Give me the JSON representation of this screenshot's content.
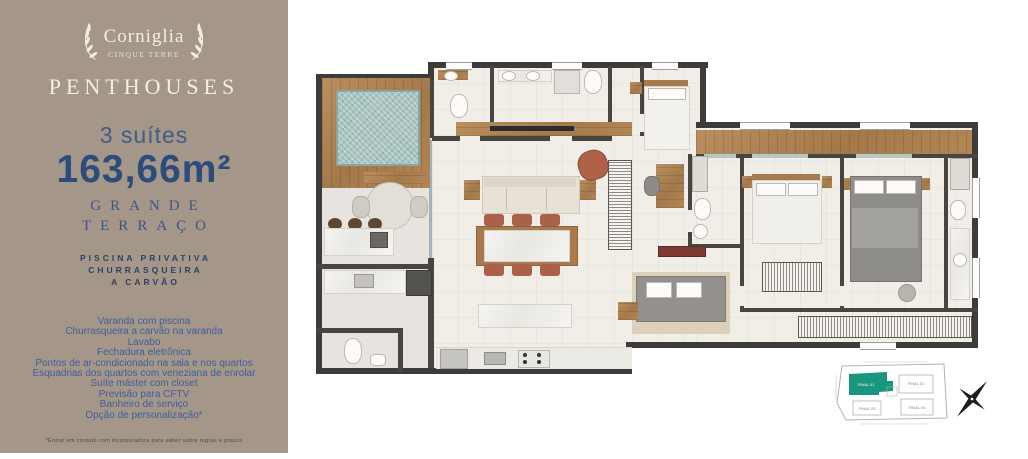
{
  "sidebar": {
    "brand": {
      "name": "Corniglia",
      "tagline": "CINQUE TERRE"
    },
    "collection": "PENTHOUSES",
    "suites": "3 suítes",
    "area": "163,66m²",
    "terrace": {
      "line1": "GRANDE",
      "line2": "TERRAÇO"
    },
    "highlights": {
      "line1": "PISCINA PRIVATIVA",
      "line2": "CHURRASQUEIRA",
      "line3": "A CARVÃO"
    },
    "features": [
      "Varanda com piscina",
      "Churrasqueira a carvão na varanda",
      "Lavabo",
      "Fechadura eletrônica",
      "Pontos de ar-condicionado na sala e nos quartos",
      "Esquadrias dos quartos com veneziana de enrolar",
      "Suíte máster com closet",
      "Previsão para CFTV",
      "Banheiro de serviço",
      "Opção de personalização*"
    ],
    "disclaimer": "*Entrar em contato com incorporadora para saber sobre regras e prazos",
    "colors": {
      "panel": "#a49689",
      "heading_blue": "#2c4c7c",
      "text_blue": "#3f5e99",
      "cream": "#f3eee6"
    }
  },
  "floorplan": {
    "type": "furnished-penthouse-plan",
    "colors": {
      "wall": "#3e3c39",
      "wood": "#a97f52",
      "pool_water": "#a9c4c1",
      "floor": "#f1eee8"
    }
  },
  "keyplan": {
    "highlight_color": "#18967e",
    "units": [
      {
        "label": "FINAL 01",
        "highlighted": true
      },
      {
        "label": "FINAL 02",
        "highlighted": false
      },
      {
        "label": "FINAL 03",
        "highlighted": false
      },
      {
        "label": "FINAL 04",
        "highlighted": false
      }
    ]
  }
}
